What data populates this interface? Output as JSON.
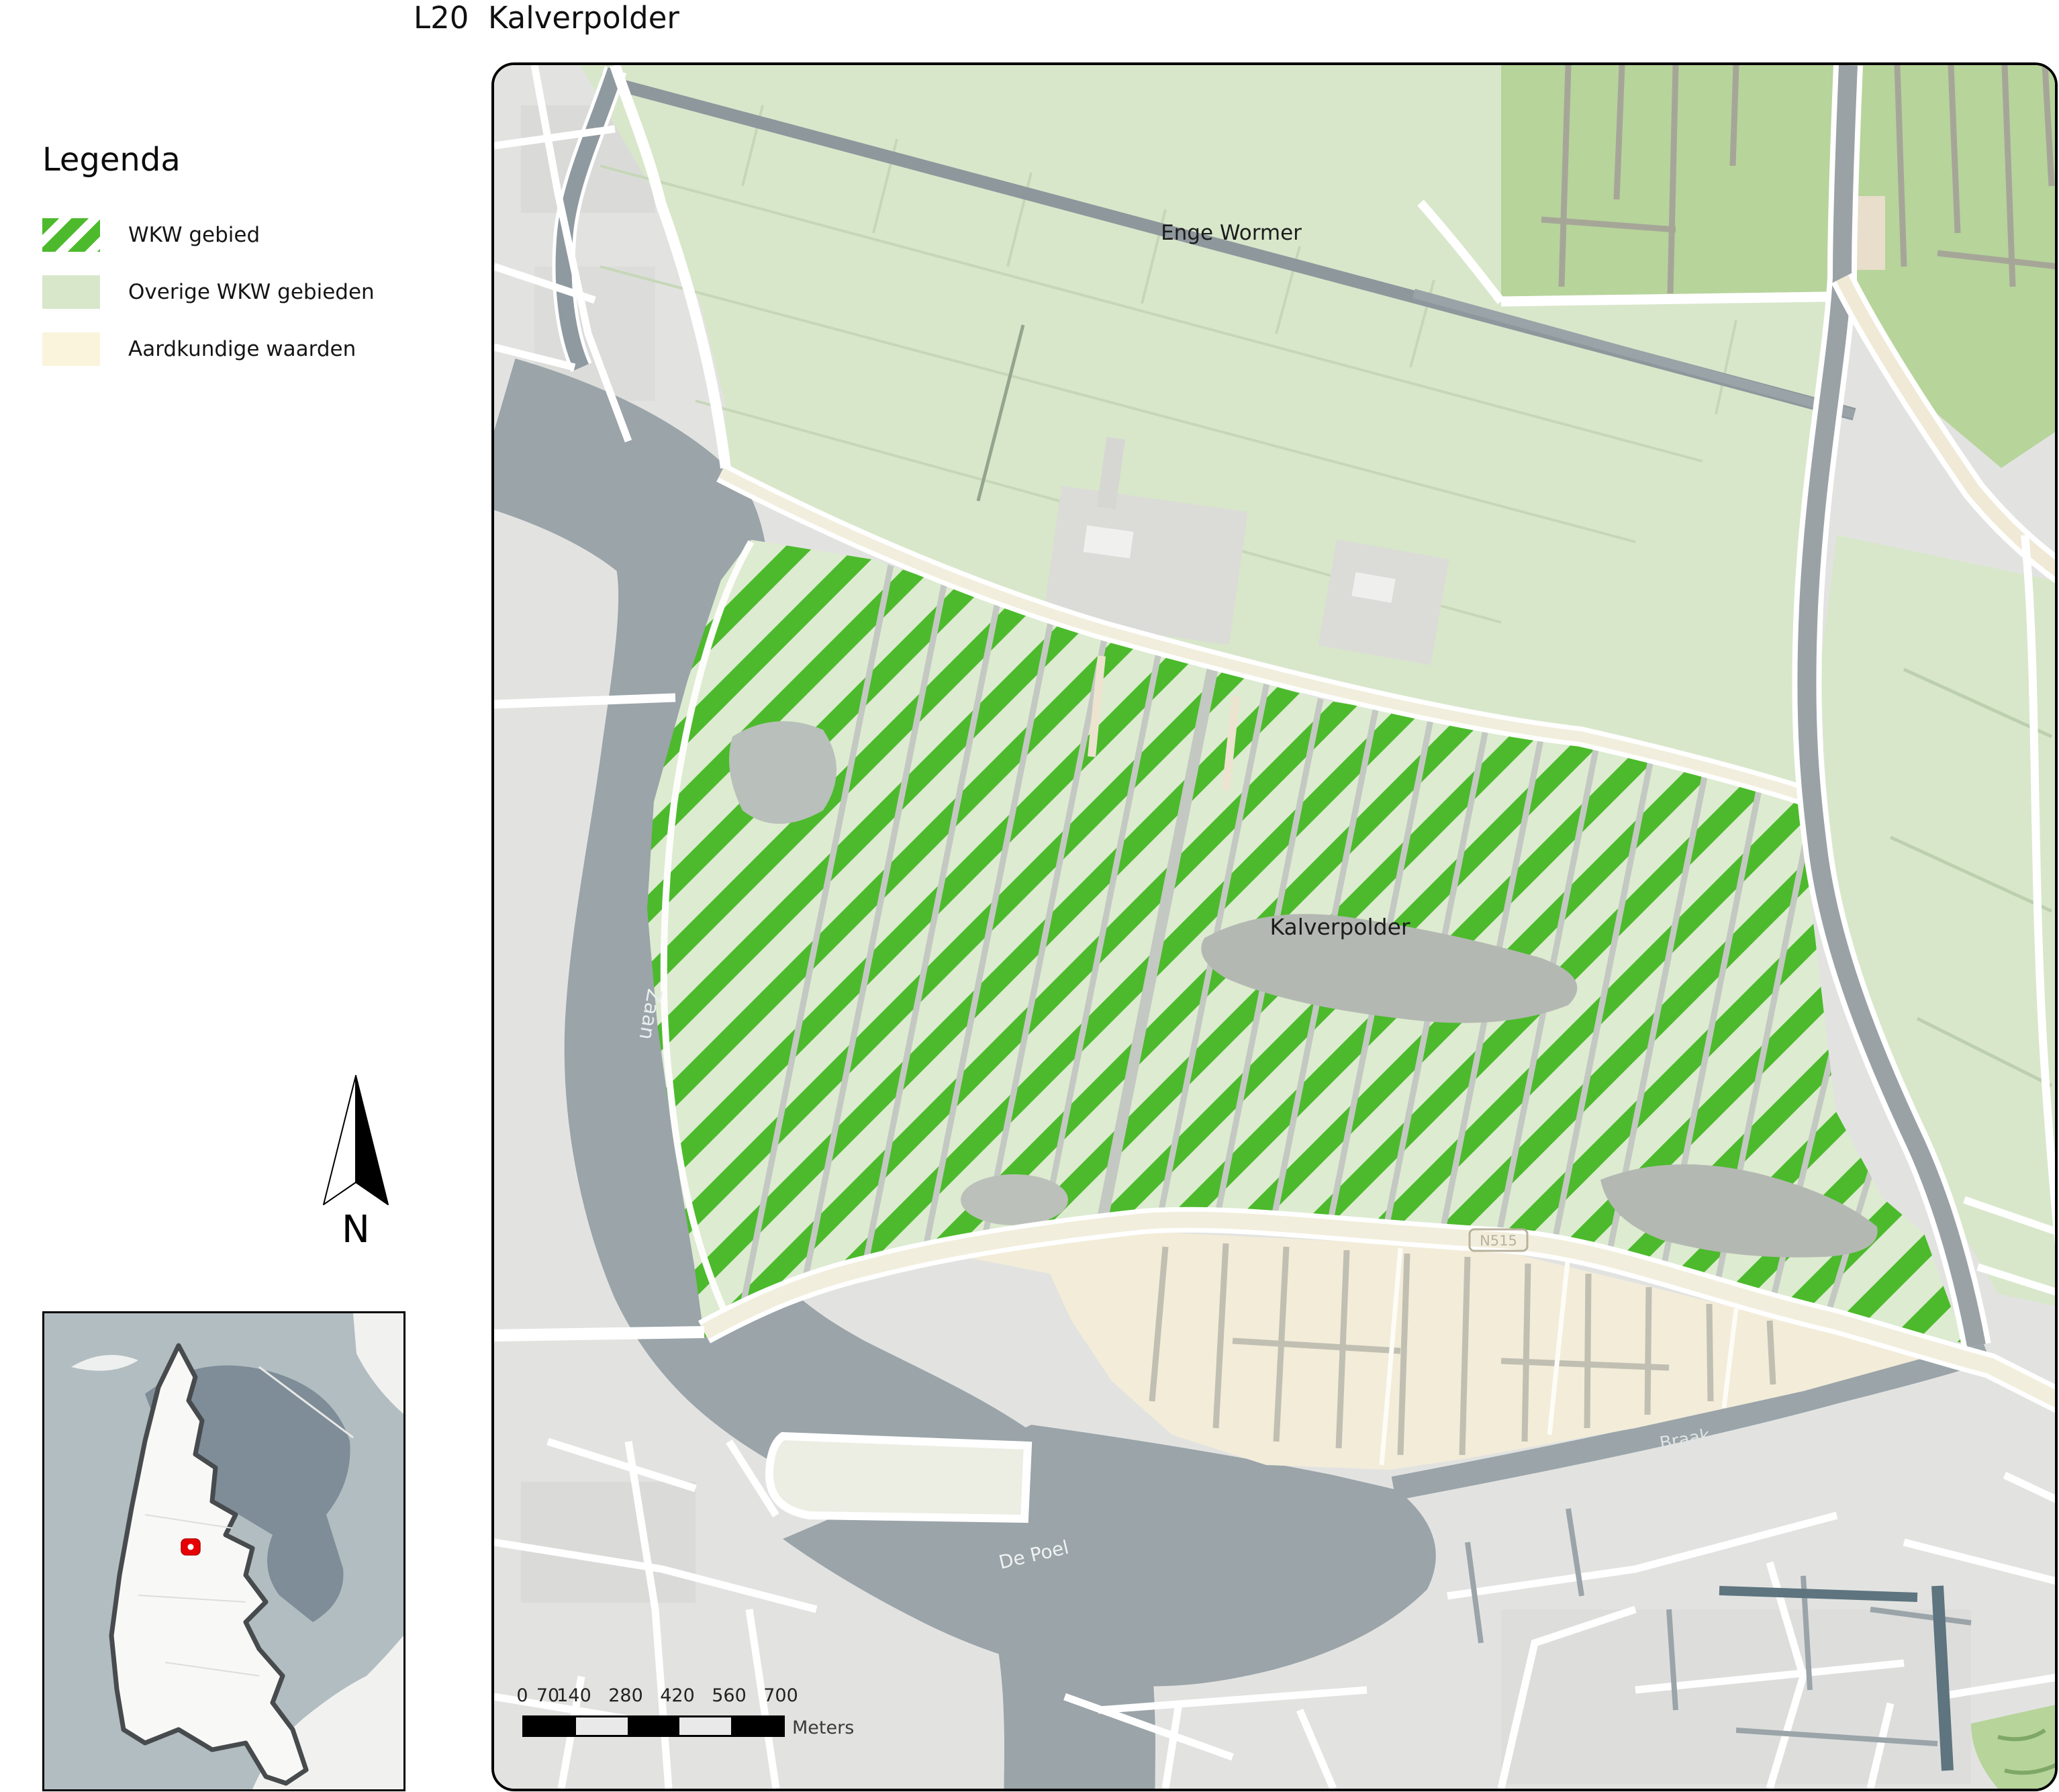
{
  "title": "L20  Kalverpolder",
  "legend": {
    "heading": "Legenda",
    "items": [
      {
        "label": "WKW gebied",
        "swatch": "hatch"
      },
      {
        "label": "Overige WKW gebieden",
        "swatch": "solid-light-green"
      },
      {
        "label": "Aardkundige waarden",
        "swatch": "solid-cream"
      }
    ]
  },
  "north_arrow": {
    "label": "N"
  },
  "map": {
    "labels": {
      "region_top": "Enge Wormer",
      "region_main": "Kalverpolder",
      "water_left": "Zaan",
      "water_bottom": "De Poel",
      "water_right": "Braak",
      "road_shield": "N515"
    }
  },
  "scale_bar": {
    "ticks": [
      "0",
      "70",
      "140",
      "280",
      "420",
      "560",
      "700"
    ],
    "unit": "Meters"
  },
  "colors": {
    "wkw_stripe": "#4cba2c",
    "wkw_background": "#ddebd1",
    "overige_wkw": "#d8e7ca",
    "overige_wkw_dark": "#b7d49b",
    "aardkundige": "#f2ecd9",
    "water": "#9aa4a9",
    "urban": "#e2e3e1",
    "marker_red": "#e60005"
  }
}
